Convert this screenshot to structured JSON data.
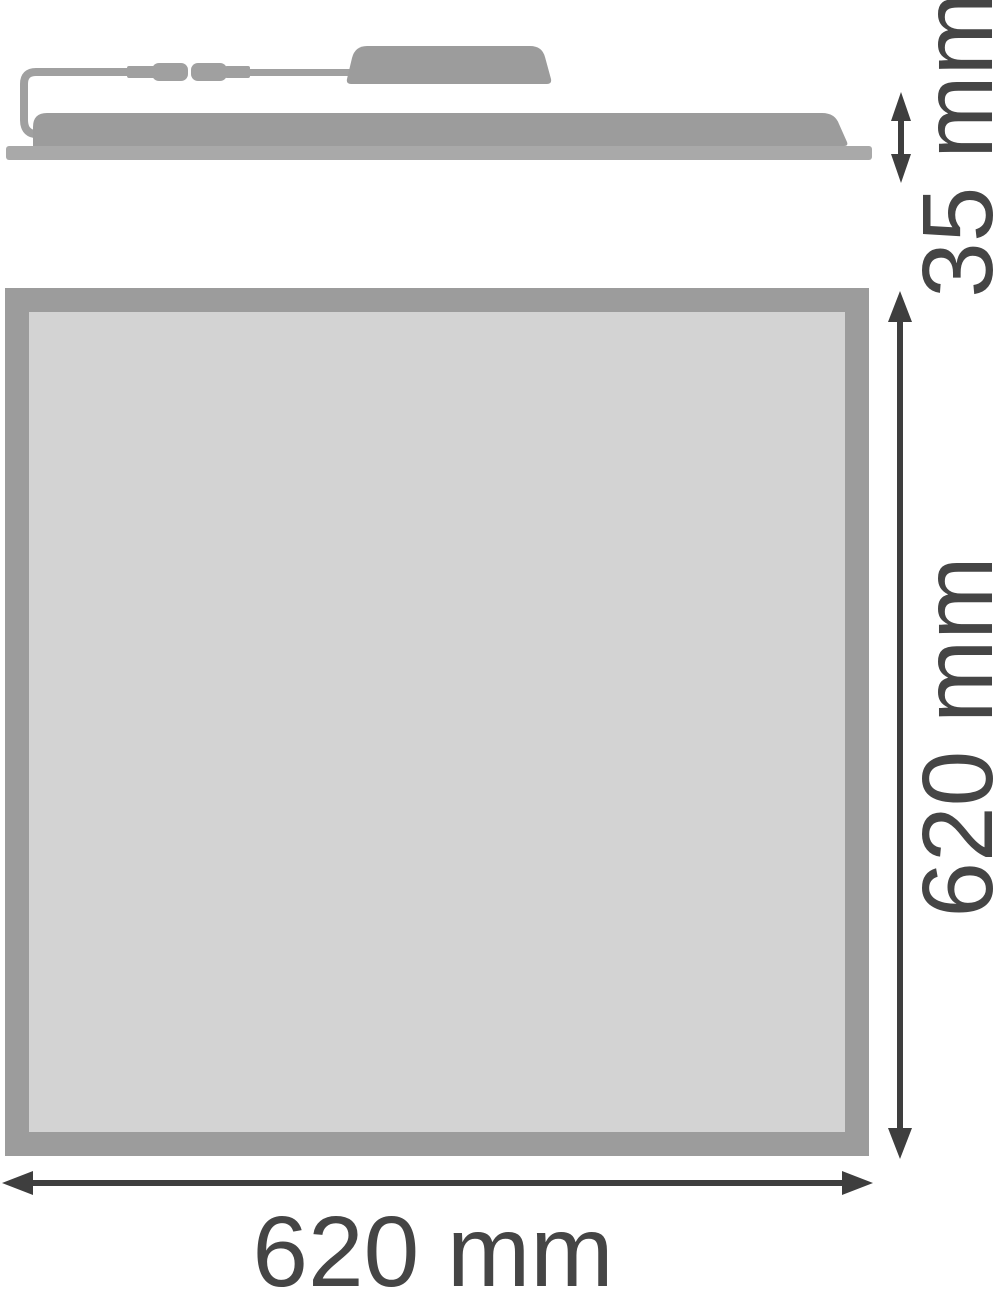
{
  "dimensions": {
    "side_height": "35 mm",
    "front_height": "620 mm",
    "front_width": "620 mm"
  },
  "palette": {
    "shape_gray": "#9c9c9c",
    "baseplate_gray": "#a9a9a9",
    "cable_gray": "#a0a0a0",
    "panel_face_gray": "#d3d3d3",
    "dimension_dark": "#3e3e3e",
    "label_color": "#454545",
    "background": "#ffffff"
  }
}
